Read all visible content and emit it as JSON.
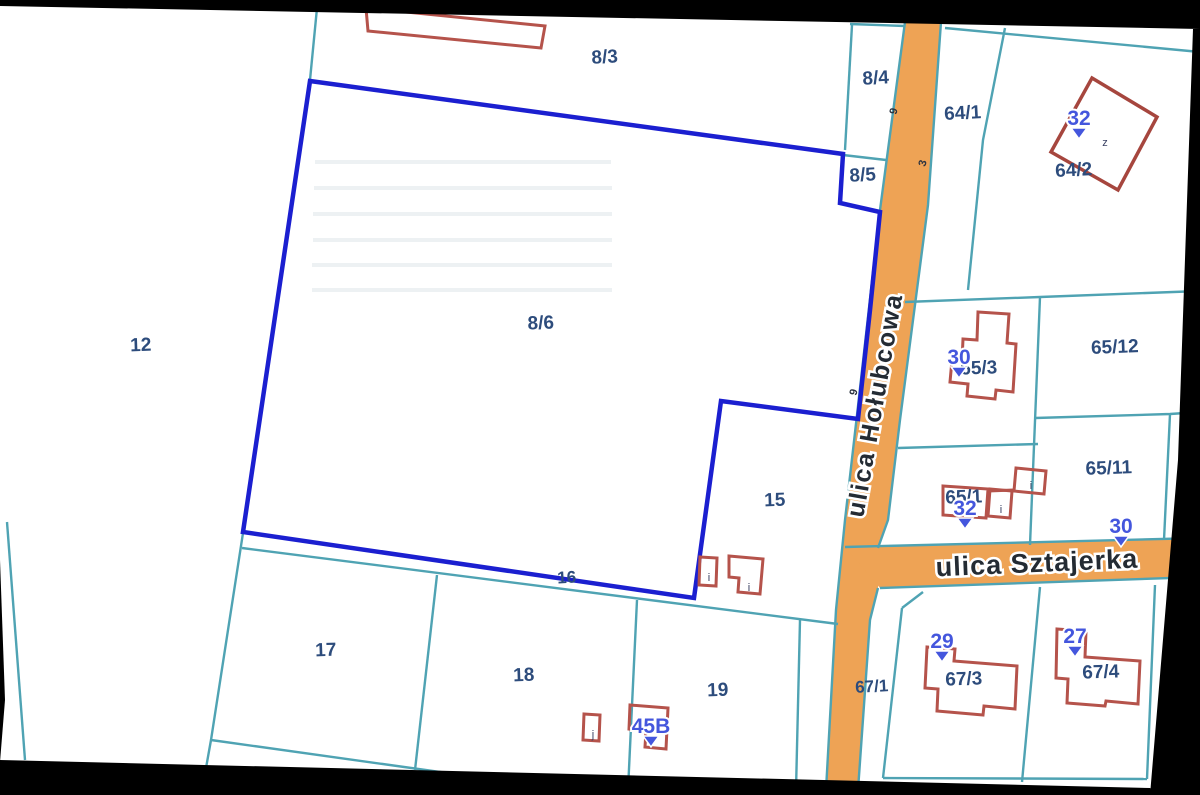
{
  "map_type": "cadastral-parcel-map",
  "colors": {
    "background": "#000000",
    "sheet": "#ffffff",
    "parcel_line": "#4fa3b3",
    "highlight_boundary": "#1b1fd0",
    "building_outline": "#b5534b",
    "road_fill": "#eea355",
    "parcel_label": "#2d4c7c",
    "address_marker": "#4456dd"
  },
  "roads": {
    "holubcowa": "ulica Hołubcowa",
    "sztajerka": "ulica Sztajerka"
  },
  "parcels": {
    "p12": "12",
    "p8_3": "8/3",
    "p8_4": "8/4",
    "p8_5": "8/5",
    "p8_6": "8/6",
    "p64_1": "64/1",
    "p64_2": "64/2",
    "p65_12": "65/12",
    "p65_3": "65/3",
    "p65_11": "65/11",
    "p65_1": "65/1",
    "p15": "15",
    "p16": "16",
    "p17": "17",
    "p18": "18",
    "p19": "19",
    "p67_1": "67/1",
    "p67_3": "67/3",
    "p67_4": "67/4"
  },
  "address_markers": {
    "m32_64_2": "32",
    "m30_65_3": "30",
    "m32_65_1": "32",
    "m30_sztajerka": "30",
    "m29_67_3": "29",
    "m27_67_4": "27",
    "m45B_19": "45B"
  },
  "building_letters": {
    "z_64_2": "z",
    "i_65_1b": "i",
    "i_65_1c": "i",
    "i_15a": "i",
    "i_15b": "i",
    "j_19a": "j",
    "i_19b": "i"
  },
  "road_digits": {
    "d9_top": "9",
    "d3_mid": "3",
    "d9_low": "9"
  }
}
